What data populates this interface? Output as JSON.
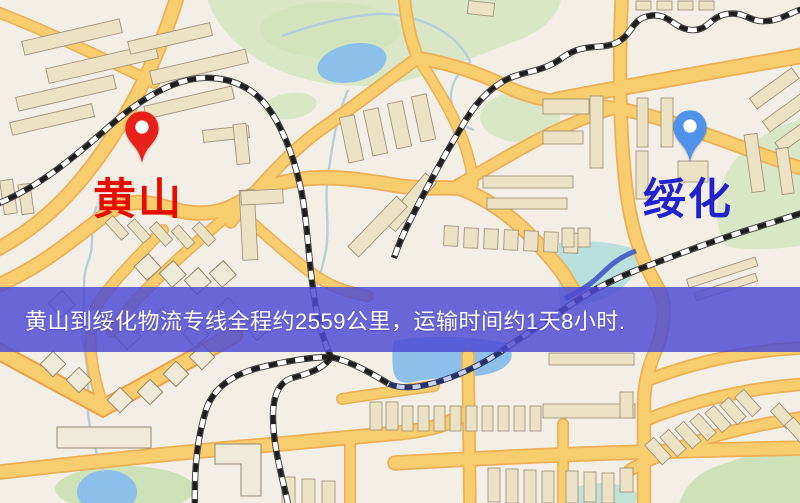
{
  "map": {
    "type": "street-map",
    "markers": [
      {
        "id": "origin",
        "city": "黄山",
        "pin_color": "#e8221b",
        "label_color": "#e60d00"
      },
      {
        "id": "destination",
        "city": "绥化",
        "pin_color": "#4e92ea",
        "label_color": "#2121cd"
      }
    ],
    "banner": {
      "text": "黄山到绥化物流专线全程约2559公里，运输时间约1天8小时.",
      "background": "#4d4bd4",
      "text_color": "#ffffff",
      "distance_km": "2559",
      "duration": "1天8小时"
    },
    "colors": {
      "background": "#f4efe6",
      "road": "#f8cd6d",
      "road_casing": "#edb056",
      "park": "#d9e7c6",
      "water": "#8cc0ea",
      "building": "#ece3c7",
      "railway": "#3a3a3a"
    }
  }
}
